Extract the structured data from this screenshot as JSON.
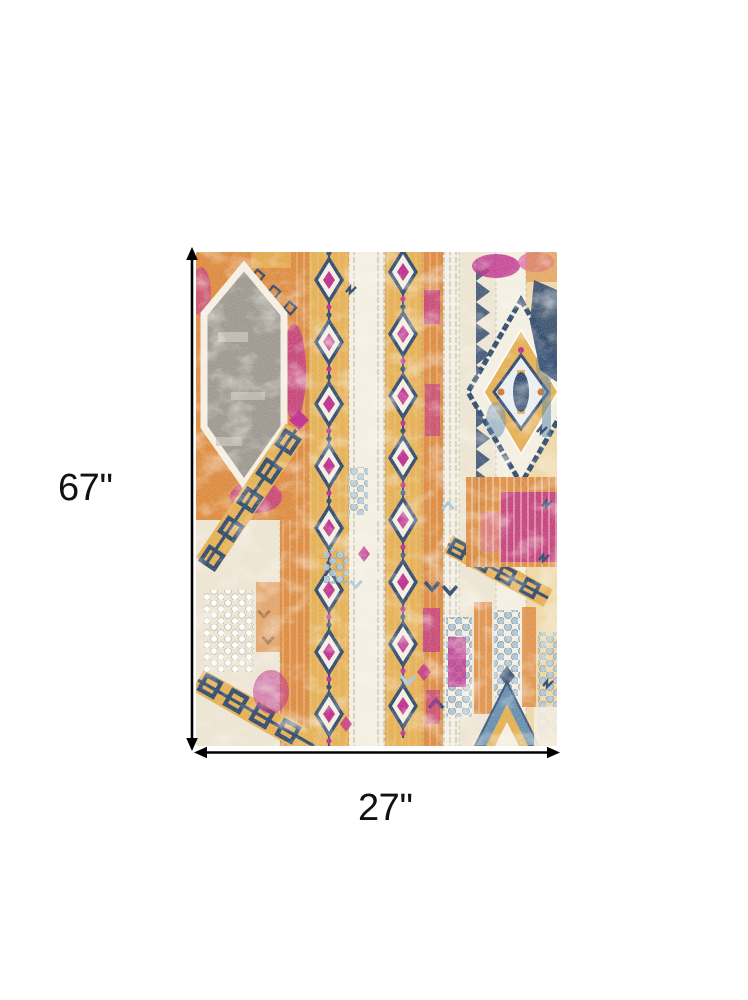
{
  "figure": {
    "description": "Area rug product image with dimension arrows",
    "background_color": "#ffffff"
  },
  "dimensions": {
    "height_label": "67''",
    "width_label": "27''",
    "arrow_color": "#000000",
    "label_color": "#111111"
  },
  "rug": {
    "style_note": "distressed bohemian tribal runner",
    "palette": {
      "cream": "#EDE5D3",
      "cream2": "#F4EFE2",
      "orange": "#DD8A3E",
      "orange2": "#CE7430",
      "gold": "#E5AF52",
      "goldpale": "#EFCD85",
      "magenta": "#BE2E8C",
      "pink": "#D868AE",
      "navy": "#2F4A6E",
      "blue": "#5B87AC",
      "bluelight": "#A9C6DA",
      "gray": "#9C9890",
      "graylight": "#C9C4B8"
    }
  }
}
